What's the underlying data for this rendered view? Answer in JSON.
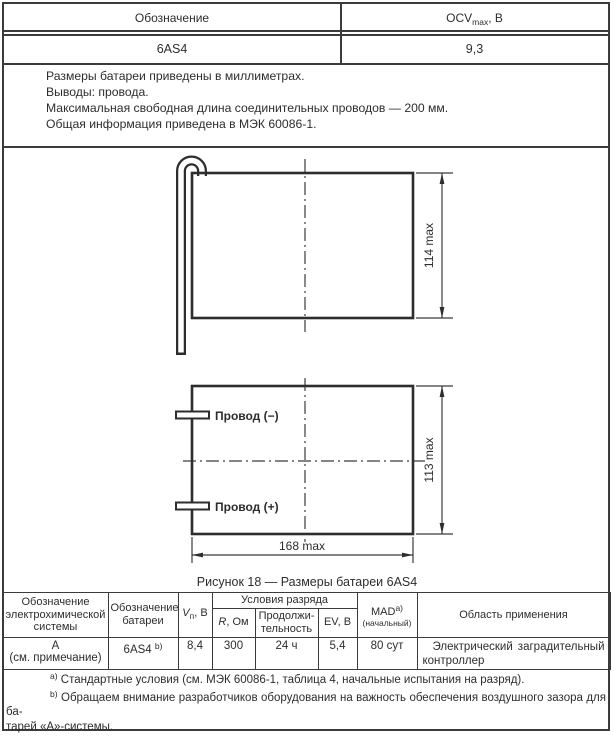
{
  "top_table": {
    "col1_header": "Обозначение",
    "col2_header": {
      "main": "OCV",
      "sub": "max",
      "suffix": ", В"
    },
    "row": {
      "designation": "6AS4",
      "ocv": "9,3"
    }
  },
  "notes": {
    "line1": "Размеры батареи приведены в миллиметрах.",
    "line2": "Выводы: провода.",
    "line3": "Максимальная свободная длина соединительных проводов — 200 мм.",
    "line4": "Общая информация приведена в МЭК 60086-1."
  },
  "figure": {
    "caption": "Рисунок 18 — Размеры батареи 6AS4",
    "dims": {
      "top_height": "114 max",
      "bottom_height": "113 max",
      "bottom_width": "168 max"
    },
    "leads": {
      "negative": "Провод (−)",
      "positive": "Провод (+)"
    }
  },
  "spec_table": {
    "headers": {
      "system": "Обозначение\nэлектрохимической\nсистемы",
      "battery": "Обозначение\nбатареи",
      "v": {
        "main": "V",
        "sub": "п",
        "suffix": ", В"
      },
      "discharge": "Условия разряда",
      "r": {
        "main": "R",
        "suffix": ", Ом"
      },
      "duration": "Продолжи-\nтельность",
      "ev": "EV, В",
      "mad": {
        "main": "MAD",
        "sup": "a)",
        "line2": "(начальный)"
      },
      "application": "Область применения"
    },
    "row": {
      "system": "А\n(см. примечание)",
      "battery": {
        "main": "6AS4 ",
        "sup": "b)"
      },
      "v": "8,4",
      "r": "300",
      "duration": "24 ч",
      "ev": "5,4",
      "mad": "80 сут",
      "application": "Электрический заградительный контроллер"
    }
  },
  "footnotes": {
    "a": {
      "marker": "a)",
      "text": " Стандартные условия (см. МЭК 60086-1, таблица 4, начальные испытания на разряд)."
    },
    "b": {
      "marker": "b)",
      "line1": " Обращаем внимание разработчиков оборудования на важность обеспечения воздушного зазора для ба-",
      "line2": "тарей «А»-системы."
    },
    "note": {
      "label": "П р и м е ч а н и е",
      "text": " — Разрядные характеристики при отсроченном на 12 мес разряде составляют 80 % MAD."
    }
  }
}
